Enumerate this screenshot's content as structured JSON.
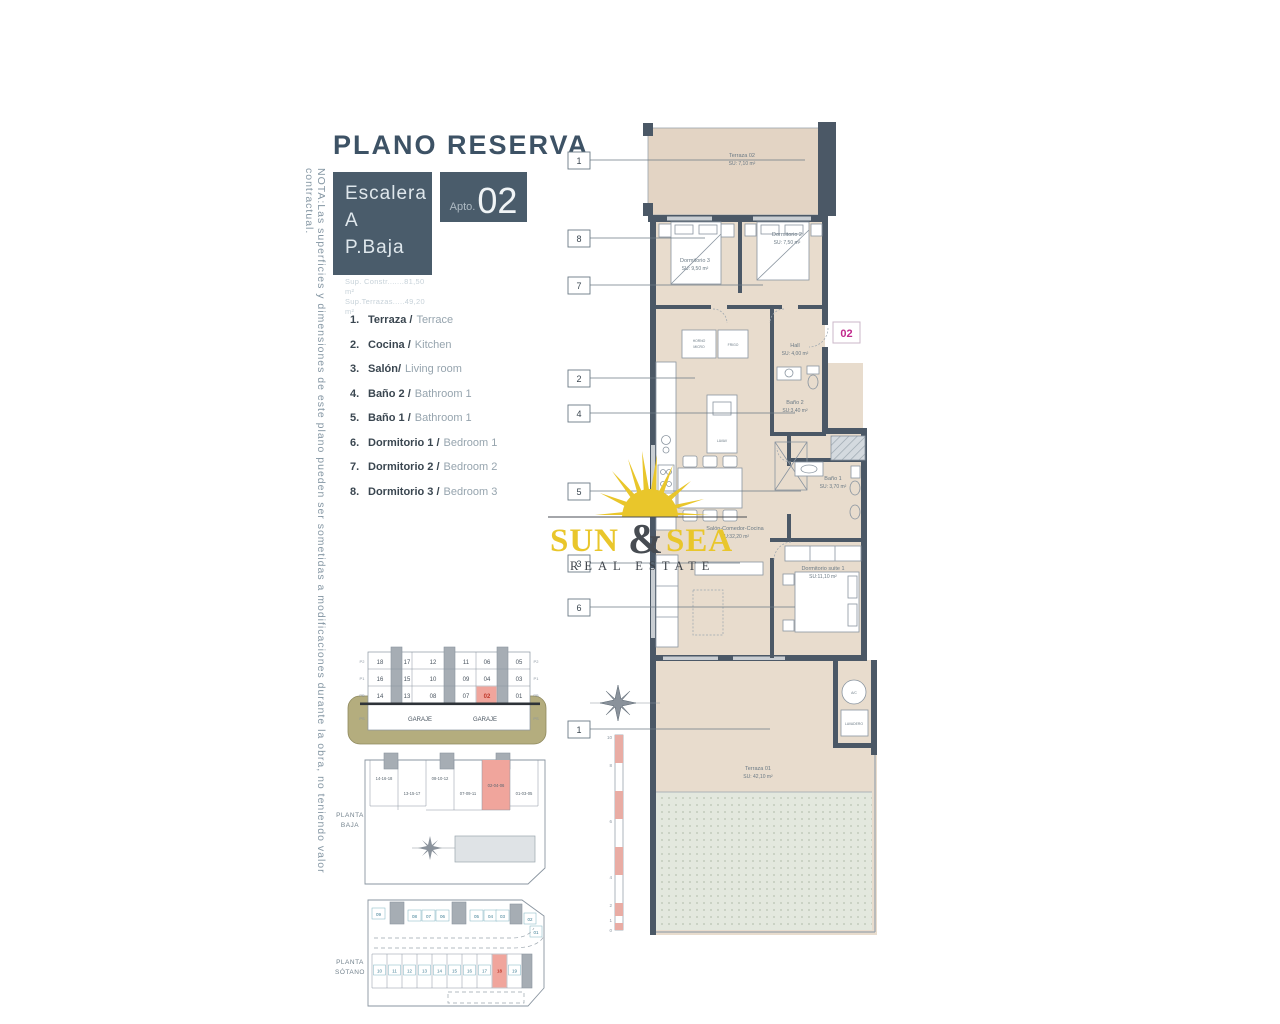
{
  "note": "NOTA:Las superficies y dimensiones de este plano pueden ser sometidas a modificaciones durante la obra, no teniendo valor contractual.",
  "header": {
    "title": "PLANO RESERVA",
    "escalera": "Escalera A",
    "planta": "P.Baja",
    "sup_constr": "Sup. Constr.......81,50 m²",
    "sup_terrazas": "Sup.Terrazas.....49,20 m²",
    "apto_prefix": "Apto.",
    "apto_num": "02"
  },
  "legend": [
    {
      "num": "1.",
      "es": "Terraza /",
      "en": "Terrace"
    },
    {
      "num": "2.",
      "es": "Cocina /",
      "en": "Kitchen"
    },
    {
      "num": "3.",
      "es": "Salón/",
      "en": "Living room"
    },
    {
      "num": "4.",
      "es": "Baño 2 /",
      "en": "Bathroom 1"
    },
    {
      "num": "5.",
      "es": "Baño 1 /",
      "en": "Bathroom 1"
    },
    {
      "num": "6.",
      "es": "Dormitorio 1 /",
      "en": "Bedroom 1"
    },
    {
      "num": "7.",
      "es": "Dormitorio 2 /",
      "en": "Bedroom 2"
    },
    {
      "num": "8.",
      "es": "Dormitorio 3 /",
      "en": "Bedroom 3"
    }
  ],
  "plan": {
    "unit_badge": "02",
    "callouts": [
      "1",
      "8",
      "7",
      "2",
      "4",
      "5",
      "3",
      "6",
      "1"
    ],
    "rooms": {
      "terraza02": {
        "name": "Terraza 02",
        "area": "SU: 7,10 m²"
      },
      "dorm3": {
        "name": "Dormitorio 3",
        "area": "SU: 9,50 m²"
      },
      "dorm2": {
        "name": "Dormitorio 2",
        "area": "SU: 7,50 m²"
      },
      "hall": {
        "name": "Hall",
        "area": "SU: 4,00 m²"
      },
      "bano2": {
        "name": "Baño 2",
        "area": "SU:3,40 m²"
      },
      "bano1": {
        "name": "Baño 1",
        "area": "SU: 3,70 m²"
      },
      "salon": {
        "name": "Salón-Comedor-Cocina",
        "area": "SU:32,20 m²"
      },
      "suite": {
        "name": "Dormitorio suite 1",
        "area": "SU:11,10 m²"
      },
      "terraza01": {
        "name": "Terraza 01",
        "area": "SU: 42,10 m²"
      }
    },
    "labels": {
      "horno1": "HORNO",
      "horno2": "MICRO",
      "frigo": "FRIGO",
      "lavav": "LAVAV",
      "ac": "A/C",
      "lavadero": "LAVADERO"
    },
    "scalebar_ticks": [
      "10",
      "8",
      "6",
      "4",
      "2",
      "1",
      "0"
    ]
  },
  "section": {
    "row_p2": [
      "18",
      "17",
      "12",
      "11",
      "06",
      "05"
    ],
    "row_p1": [
      "16",
      "15",
      "10",
      "09",
      "04",
      "03"
    ],
    "row_pb": [
      "14",
      "13",
      "08",
      "07",
      "02",
      "01"
    ],
    "garaje_left": "GARAJE",
    "garaje_right": "GARAJE",
    "floor_labels": [
      "P2",
      "P1",
      "PB",
      "PS"
    ]
  },
  "planta_baja": {
    "label_line1": "PLANTA",
    "label_line2": "BAJA",
    "blocks": [
      "14-16-18",
      "13-15-17",
      "08-10-12",
      "07-09-11",
      "02-04-06",
      "01-03-05"
    ]
  },
  "planta_sotano": {
    "label_line1": "PLANTA",
    "label_line2": "SÓTANO",
    "top_row": [
      "09",
      "08",
      "07",
      "06",
      "05",
      "04",
      "03",
      "02",
      "01"
    ],
    "bottom_row": [
      "10",
      "11",
      "12",
      "13",
      "14",
      "15",
      "16",
      "17",
      "18",
      "19"
    ]
  },
  "logo": {
    "word1": "SUN",
    "amp": "&",
    "word2": "SEA",
    "tagline": "REAL ESTATE"
  },
  "colors": {
    "slate": "#4a5c6b",
    "wall": "#4b5866",
    "floor_beige": "#e8dccd",
    "highlight_salmon": "#f0a59c",
    "magenta": "#c12a8d",
    "logo_yellow": "#e9c62b",
    "ground_khaki": "#b4ad7e"
  }
}
